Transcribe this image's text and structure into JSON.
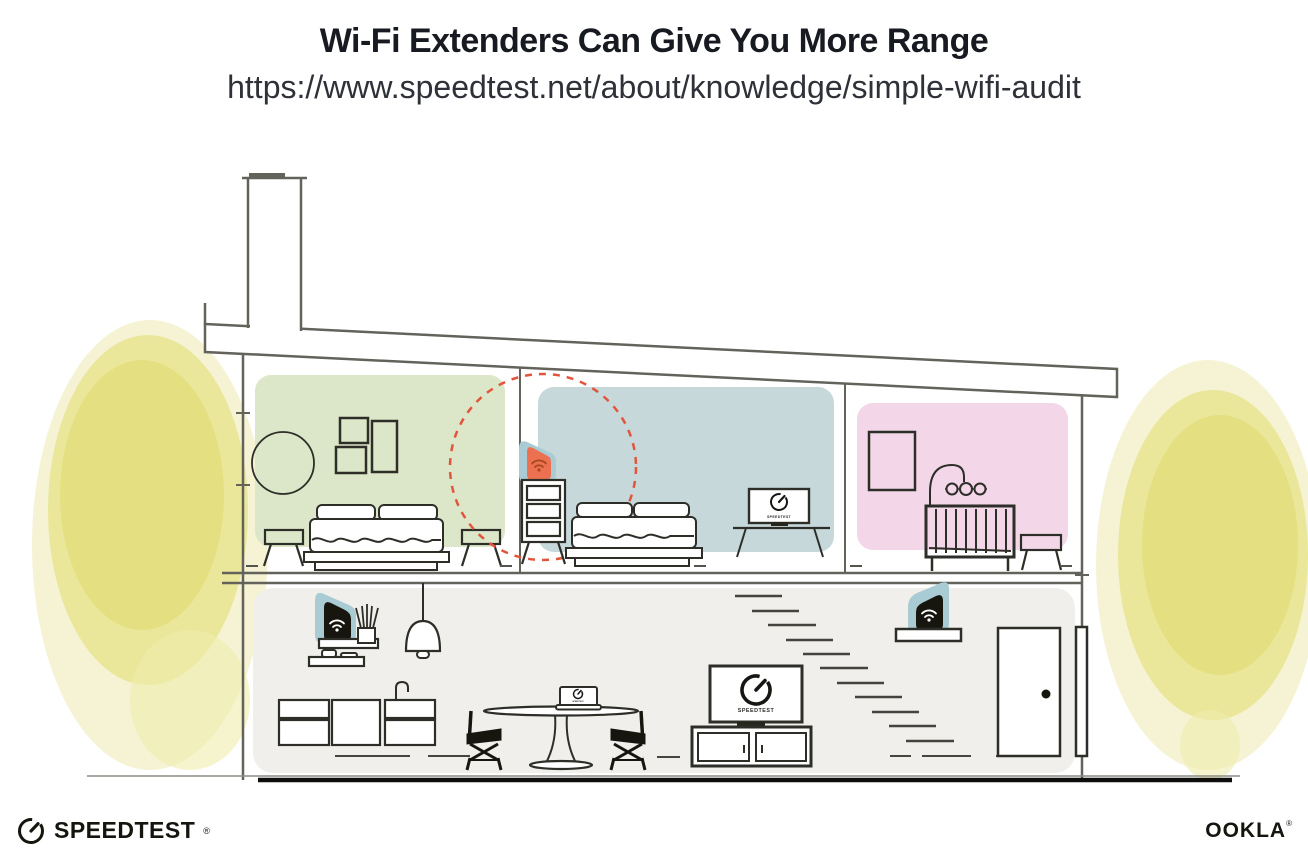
{
  "header": {
    "title": "Wi-Fi Extenders Can Give You More Range",
    "url": "https://www.speedtest.net/about/knowledge/simple-wifi-audit"
  },
  "illustration": {
    "bedroom_tv_label": "SPEEDTEST",
    "living_tv_label": "SPEEDTEST",
    "laptop_label": "SPEEDTEST",
    "colors": {
      "room_green": "#dce6c8",
      "room_blue": "#c6d8da",
      "room_pink": "#f3d7e9",
      "floor_gray": "#f0efec",
      "device_blob_teal": "#a9cbd3",
      "extender_orange": "#ed7150",
      "extender_wifi_dark_orange": "#a84a20",
      "wifi_range_red": "#e2553d",
      "foliage_yellow": "#e6e388",
      "structure_line": "#63635c",
      "furniture_line": "#2e2e29"
    }
  },
  "footer": {
    "speedtest": {
      "label": "SPEEDTEST",
      "trademark": "®"
    },
    "ookla": {
      "label": "OOKLA",
      "trademark": "®"
    }
  }
}
